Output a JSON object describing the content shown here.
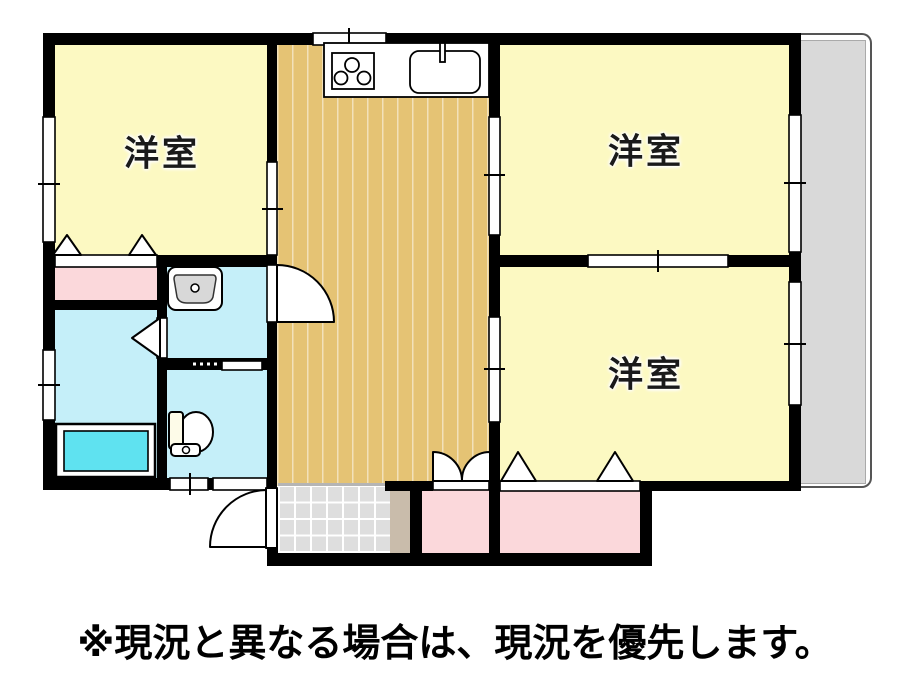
{
  "plan": {
    "title": "floor-plan",
    "rooms": [
      {
        "id": "room-top-left",
        "label": "洋室"
      },
      {
        "id": "room-top-right",
        "label": "洋室"
      },
      {
        "id": "room-bottom-right",
        "label": "洋室"
      }
    ],
    "unlabeled_areas": [
      "kitchen-dining",
      "washroom",
      "toilet",
      "bathroom",
      "closet",
      "closet",
      "closet",
      "entrance",
      "shoe-cabinet",
      "balcony"
    ],
    "icons": [
      "stove-icon",
      "kitchen-sink-icon",
      "washbasin-icon",
      "toilet-icon",
      "bathtub-icon",
      "door-swing-icon",
      "double-door-swing-icon",
      "folding-door-triangle-icon",
      "sliding-door-hatch-icon",
      "window-icon"
    ],
    "colors": {
      "room_yellow": "#fcf9c2",
      "kitchen_wood": "#e5c374",
      "wet_area_cyan": "#c5eff9",
      "bathtub_cyan": "#5fe2f0",
      "closet_pink": "#fbd8db",
      "entry_tile_gray": "#dedede",
      "shoe_cabinet_tan": "#c9bcab",
      "balcony_gray": "#d9d9d9",
      "wall_black": "#000000"
    }
  },
  "notice": "※現況と異なる場合は、現況を優先します。"
}
